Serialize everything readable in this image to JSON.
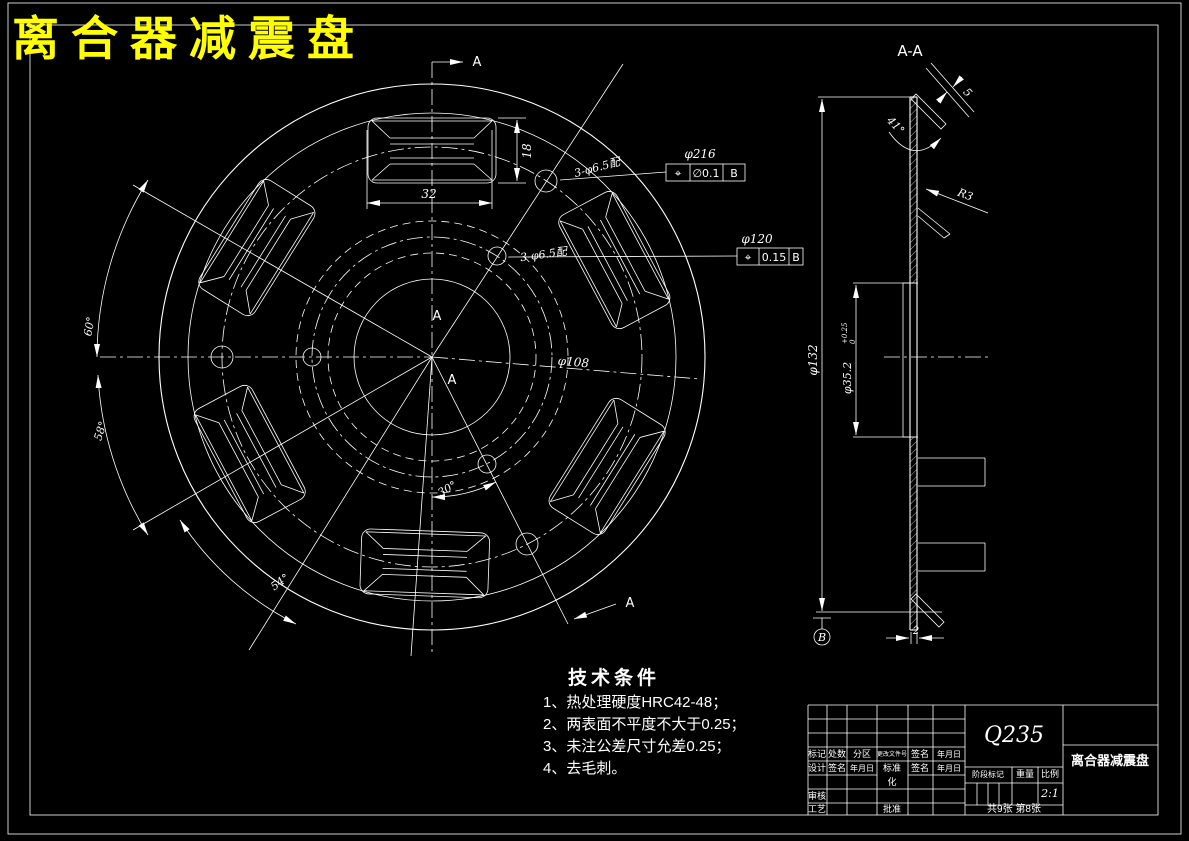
{
  "title": "离合器减震盘",
  "colors": {
    "background": "#000000",
    "line": "#ffffff",
    "title_text": "#ffff00"
  },
  "main_view": {
    "dim_phi216": "φ216",
    "dim_phi120": "φ120",
    "dim_phi108": "φ108",
    "slot_width": "32",
    "slot_height": "18",
    "holes_note_outer": "3-φ6.5配",
    "holes_note_inner": "3-φ6.5配",
    "angle_60": "60°",
    "angle_58": "58°",
    "angle_54": "54°",
    "angle_30": "30°",
    "section_letter": "A",
    "fcf_outer": {
      "symbol": "⌖",
      "tolerance": "∅0.1",
      "datum": "B"
    },
    "fcf_inner": {
      "symbol": "⌖",
      "tolerance": "0.15",
      "datum": "B"
    }
  },
  "section_view": {
    "label": "A-A",
    "dia_outer": "φ132",
    "bore": {
      "dim": "φ35.2",
      "tol_up": "+0.25",
      "tol_dn": "0"
    },
    "angle": "41°",
    "tab_thickness": "5",
    "fillet": "R3",
    "plate_thickness": "2",
    "datum": "B"
  },
  "tech_notes": {
    "title": "技术条件",
    "items": [
      "1、热处理硬度HRC42-48；",
      "2、两表面不平度不大于0.25；",
      "3、未注公差尺寸允差0.25；",
      "4、去毛刺。"
    ]
  },
  "title_block": {
    "material": "Q235",
    "part_name": "离合器减震盘",
    "scale_value": "2:1",
    "sheet_info": "共9张 第8张",
    "header_row": [
      "标记",
      "处数",
      "分区",
      "更改文件号",
      "签名",
      "年月日"
    ],
    "design_row": [
      "设计",
      "签名",
      "年月日",
      "标准",
      "签名",
      "年月日"
    ],
    "biaozhunhua_wrap": "化",
    "reviewer": "审核",
    "process": "工艺",
    "approve": "批准",
    "stage": "阶段标记",
    "weight": "重量",
    "scale": "比例"
  }
}
